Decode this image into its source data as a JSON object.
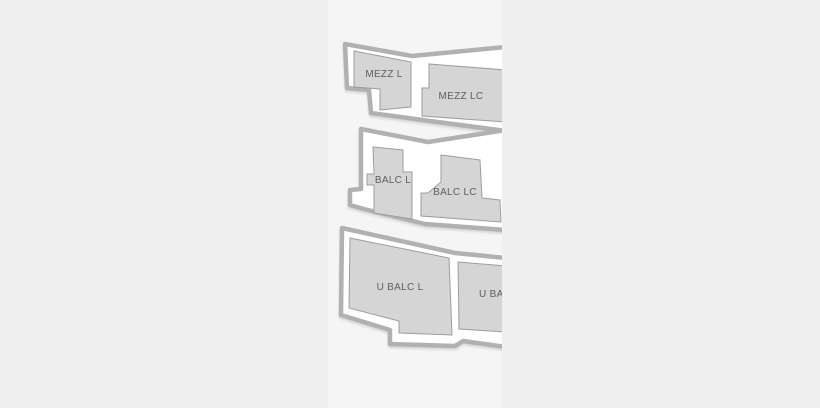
{
  "canvas": {
    "outer_background": "#efefef",
    "strip_background": "#f5f5f5"
  },
  "map": {
    "type": "venue-seating-map",
    "colors": {
      "tier_outline": "#b1b1b1",
      "tier_fill": "#ffffff",
      "section_fill": "#d5d5d5",
      "section_stroke": "#9d9d9d",
      "label": "#5e5e5e"
    },
    "tiers": [
      {
        "name": "mezzanine"
      },
      {
        "name": "balcony"
      },
      {
        "name": "upper-balcony"
      }
    ],
    "sections": [
      {
        "id": "mezz-l",
        "label": "MEZZ L"
      },
      {
        "id": "mezz-lc",
        "label": "MEZZ LC"
      },
      {
        "id": "balc-l",
        "label": "BALC L"
      },
      {
        "id": "balc-lc",
        "label": "BALC LC"
      },
      {
        "id": "u-balc-l",
        "label": "U BALC L"
      },
      {
        "id": "u-balc-c",
        "label": "U BALC"
      }
    ]
  }
}
